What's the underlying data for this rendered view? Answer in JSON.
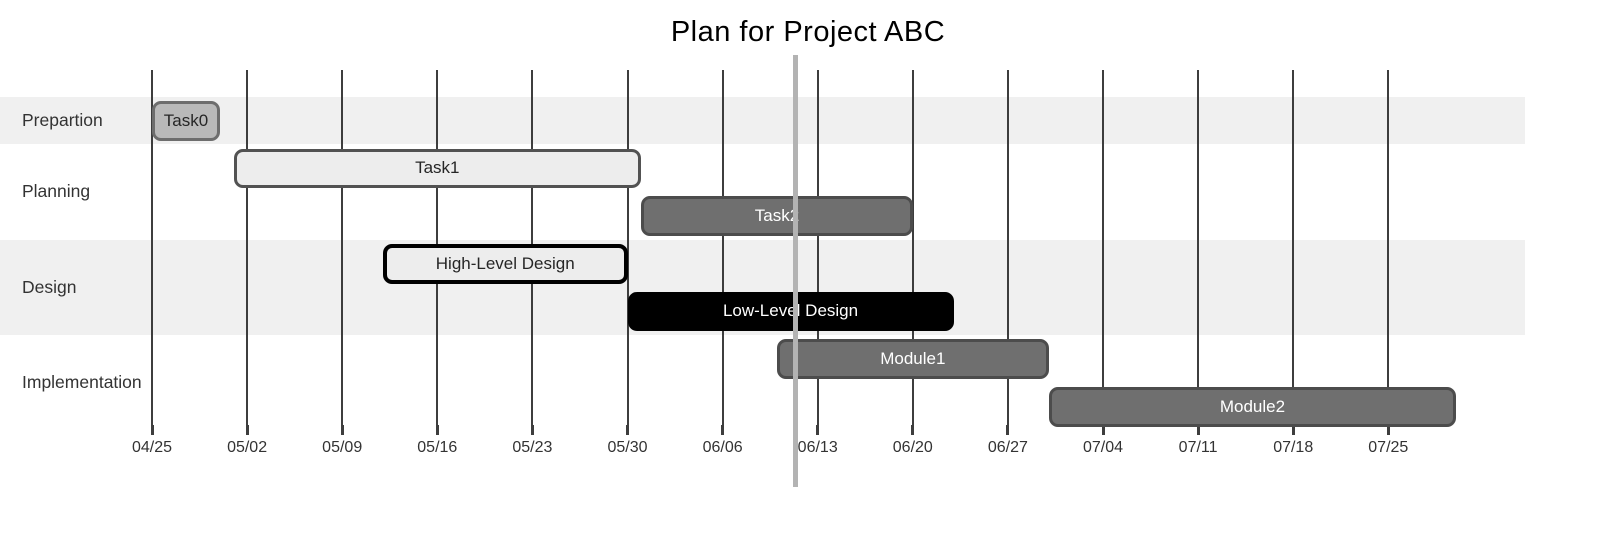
{
  "title": "Plan for Project ABC",
  "colors": {
    "band": "#f0f0f0",
    "grid": "#3d3d3d",
    "axis_text": "#333333",
    "section_text": "#333333",
    "title_text": "#000000",
    "today": "#b3b3b3",
    "bar_gray_fill": "#b9b9b9",
    "bar_gray_border": "#6d6d6d",
    "bar_light_fill": "#ededed",
    "bar_light_border": "#525252",
    "bar_crit_border": "#000000",
    "bar_dark_fill": "#6f6f6f",
    "bar_dark_border": "#4c4c4c",
    "bar_black_fill": "#000000",
    "bar_text_dark": "#262626",
    "bar_text_light": "#ffffff"
  },
  "chart_data": {
    "type": "gantt",
    "title": "Plan for Project ABC",
    "x_axis": {
      "tick_labels": [
        "04/25",
        "05/02",
        "05/09",
        "05/16",
        "05/23",
        "05/30",
        "06/06",
        "06/13",
        "06/20",
        "06/27",
        "07/04",
        "07/11",
        "07/18",
        "07/25"
      ],
      "tick_interval_days": 7
    },
    "sections": [
      {
        "name": "Prepartion",
        "tasks": [
          {
            "label": "Task0",
            "start": "04/25",
            "end": "04/30",
            "start_day": 0,
            "end_day": 5,
            "style": "gray"
          }
        ]
      },
      {
        "name": "Planning",
        "tasks": [
          {
            "label": "Task1",
            "start": "05/01",
            "end": "05/31",
            "start_day": 6,
            "end_day": 36,
            "style": "light"
          },
          {
            "label": "Task2",
            "start": "05/31",
            "end": "06/20",
            "start_day": 36,
            "end_day": 56,
            "style": "dark"
          }
        ]
      },
      {
        "name": "Design",
        "tasks": [
          {
            "label": "High-Level Design",
            "start": "05/12",
            "end": "05/30",
            "start_day": 17,
            "end_day": 35,
            "style": "light-crit"
          },
          {
            "label": "Low-Level Design",
            "start": "05/30",
            "end": "06/23",
            "start_day": 35,
            "end_day": 59,
            "style": "black"
          }
        ]
      },
      {
        "name": "Implementation",
        "tasks": [
          {
            "label": "Module1",
            "start": "06/10",
            "end": "06/30",
            "start_day": 46,
            "end_day": 66,
            "style": "dark"
          },
          {
            "label": "Module2",
            "start": "06/30",
            "end": "07/30",
            "start_day": 66,
            "end_day": 96,
            "style": "dark"
          }
        ]
      }
    ],
    "today_marker": {
      "day": 47.4,
      "date_estimate": "06/11"
    },
    "grid": true,
    "legend": false
  }
}
